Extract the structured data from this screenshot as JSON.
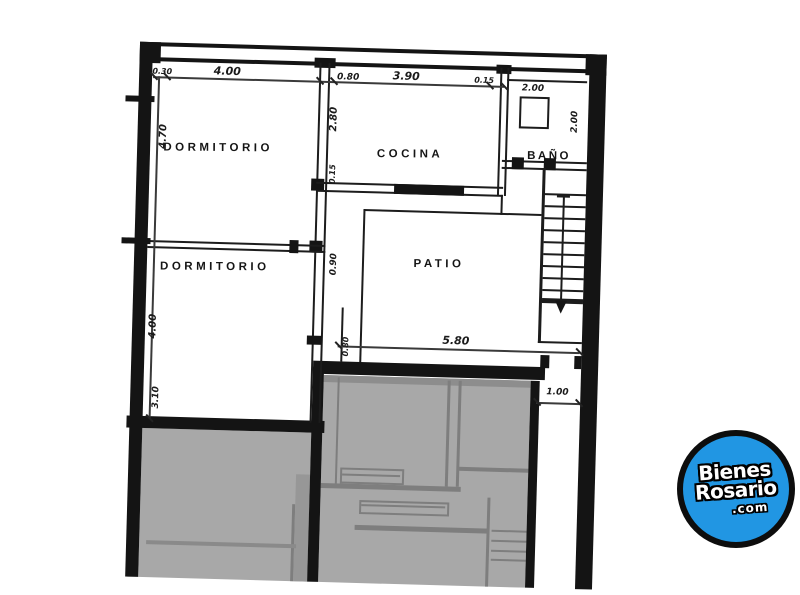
{
  "plan": {
    "rooms": {
      "dormitorio1": "DORMITORIO",
      "dormitorio2": "DORMITORIO",
      "cocina": "COCINA",
      "bano": "BAÑO",
      "patio": "PATIO"
    },
    "dimensions": {
      "top_030": "0.30",
      "top_400": "4.00",
      "top_080": "0.80",
      "top_390": "3.90",
      "top_015": "0.15",
      "bano_sq_200": "2.00",
      "bano_right_200": "2.00",
      "left_470": "4.70",
      "cocina_280": "2.80",
      "cocina_015": "0.15",
      "door_090": "0.90",
      "left_400": "4.00",
      "left_310": "3.10",
      "door_080": "0.80",
      "patio_580": "5.80",
      "exit_100": "1.00"
    }
  },
  "logo": {
    "line1": "Bienes",
    "line2": "Rosario",
    "line3": ".com",
    "accent_blue": "#2196e3"
  }
}
